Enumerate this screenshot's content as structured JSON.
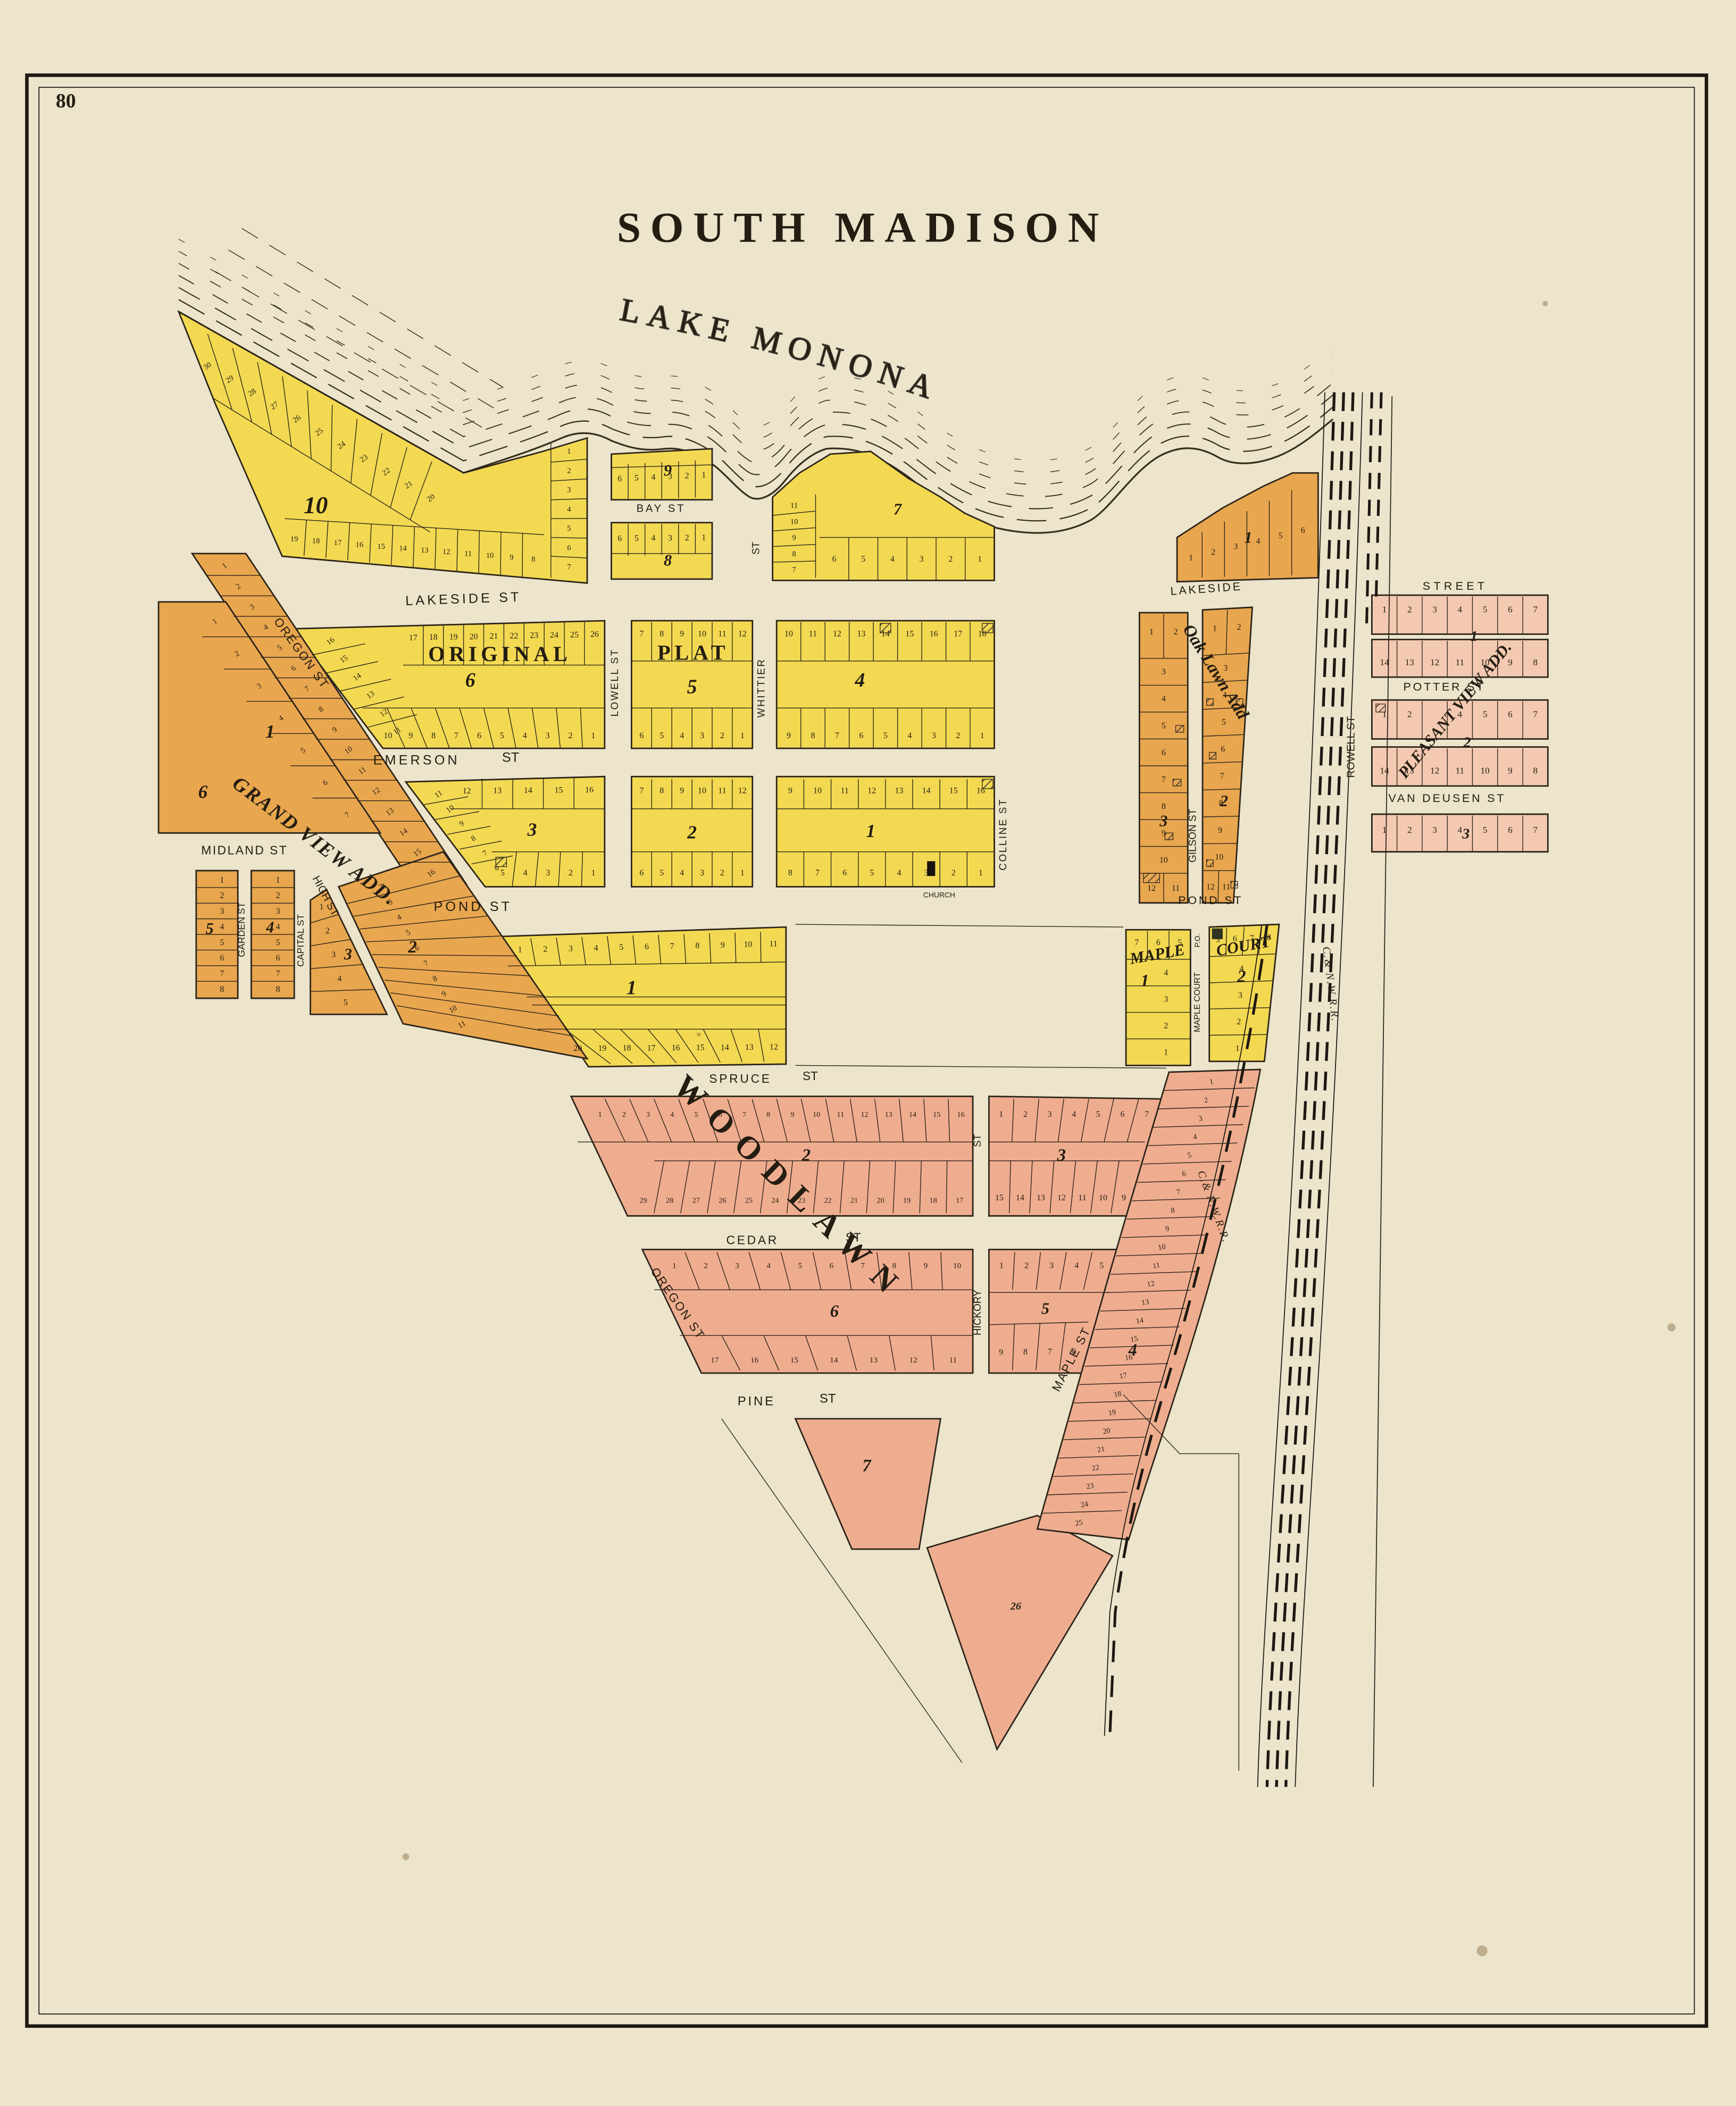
{
  "page": {
    "number": "80",
    "title": "SOUTH MADISON"
  },
  "lake": {
    "name": "LAKE MONONA"
  },
  "railroads": {
    "west_label": "C.& N.W.R.R.",
    "east_label": "C.& N.W.R.R."
  },
  "streets": {
    "lakeside_w": "LAKESIDE ST",
    "lakeside_e": "LAKESIDE",
    "bay": "BAY ST",
    "emerson": "EMERSON",
    "emerson_st": "ST",
    "lowell": "LOWELL ST",
    "whittier": "WHITTIER",
    "whittier_st": "ST",
    "colline": "COLLINE ST",
    "pond_w": "POND ST",
    "pond_e": "POND ST",
    "oregon_upper": "OREGON ST",
    "oregon_lower": "OREGON ST",
    "midland": "MIDLAND ST",
    "garden": "GARDEN ST",
    "capital": "CAPITAL ST",
    "high": "HIGH ST",
    "gilson": "GILSON ST",
    "rowell": "ROWELL ST",
    "street": "STREET",
    "potter": "POTTER ST",
    "van_deusen": "VAN DEUSEN ST",
    "spruce": "SPRUCE",
    "spruce_st": "ST",
    "cedar": "CEDAR",
    "cedar_st": "ST",
    "pine": "PINE",
    "pine_st": "ST",
    "hickory": "HICKORY",
    "hickory_st_upper": "ST",
    "maple": "MAPLE ST",
    "maple_court": "MAPLE COURT",
    "po": "P.O.",
    "church": "CHURCH"
  },
  "additions": {
    "original": "ORIGINAL",
    "plat": "PLAT",
    "grand_view": "GRAND VIEW ADD.",
    "oak_lawn": "Oak Lawn Add",
    "pleasant_view": "PLEASANT VIEW ADD.",
    "woodlawn": "WOODLAWN",
    "maple_court_1": "MAPLE",
    "maple_court_2": "COURT"
  },
  "blocks": {
    "op10": {
      "num": "10",
      "shore": [
        30,
        29,
        28,
        27,
        26,
        25,
        24,
        23,
        22,
        21,
        20
      ],
      "bottom": [
        19,
        18,
        17,
        16,
        15,
        14,
        13,
        12,
        11,
        10,
        9,
        8
      ],
      "east": [
        1,
        2,
        3,
        4,
        5,
        6,
        7
      ]
    },
    "op9": {
      "num": "9",
      "row": [
        6,
        5,
        4,
        3,
        2,
        1
      ]
    },
    "op8": {
      "num": "8",
      "row": [
        6,
        5,
        4,
        3,
        2,
        1
      ]
    },
    "op7": {
      "num": "7",
      "west": [
        11,
        10,
        9,
        8,
        7
      ],
      "bottom": [
        6,
        5,
        4,
        3,
        2,
        1
      ]
    },
    "op6": {
      "num": "6",
      "top": [
        17,
        18,
        19,
        20,
        21,
        22,
        23,
        24,
        25,
        26
      ],
      "diag": [
        16,
        15,
        14,
        13,
        12,
        11
      ],
      "bottom": [
        10,
        9,
        8,
        7,
        6,
        5,
        4,
        3,
        2,
        1
      ]
    },
    "op5": {
      "num": "5",
      "top": [
        7,
        8,
        9,
        10,
        11,
        12
      ],
      "bottom": [
        6,
        5,
        4,
        3,
        2,
        1
      ]
    },
    "op4": {
      "num": "4",
      "top": [
        10,
        11,
        12,
        13,
        14,
        15,
        16,
        17,
        18
      ],
      "bottom": [
        9,
        8,
        7,
        6,
        5,
        4,
        3,
        2,
        1
      ]
    },
    "op3": {
      "num": "3",
      "top": [
        12,
        13,
        14,
        15,
        16
      ],
      "diag": [
        11,
        10,
        9,
        8,
        7,
        6
      ],
      "bottom": [
        5,
        4,
        3,
        2,
        1
      ]
    },
    "op2": {
      "num": "2",
      "top": [
        7,
        8,
        9,
        10,
        11,
        12
      ],
      "bottom": [
        6,
        5,
        4,
        3,
        2,
        1
      ]
    },
    "op1": {
      "num": "1",
      "top": [
        9,
        10,
        11,
        12,
        13,
        14,
        15,
        16
      ],
      "bottom": [
        8,
        7,
        6,
        5,
        4,
        3,
        2,
        1
      ]
    },
    "pond1": {
      "num": "1",
      "top": [
        1,
        2,
        3,
        4,
        5,
        6,
        7,
        8,
        9,
        10,
        11
      ],
      "bottom": [
        20,
        19,
        18,
        17,
        16,
        15,
        14,
        13,
        12
      ]
    },
    "mc1": {
      "num": "1",
      "top": [
        7,
        6,
        5
      ],
      "rows": [
        4,
        3,
        2,
        1
      ]
    },
    "mc2": {
      "num": "2",
      "top": [
        5,
        6,
        7,
        8
      ],
      "rows": [
        4,
        3,
        2,
        1
      ]
    },
    "gv1": {
      "num": "1",
      "lots": [
        1,
        2,
        3,
        4,
        5,
        6,
        7,
        8,
        9,
        10,
        11,
        12,
        13,
        14,
        15,
        16
      ]
    },
    "gv2": {
      "num": "2",
      "lots": [
        2,
        3,
        4,
        5,
        6,
        7,
        8,
        9,
        10,
        11
      ]
    },
    "gv3": {
      "num": "3",
      "rows": [
        1,
        2,
        3,
        4,
        5
      ]
    },
    "gv4": {
      "num": "4",
      "rows": [
        1,
        2,
        3,
        4,
        5,
        6,
        7,
        8
      ]
    },
    "gv5": {
      "num": "5",
      "rows": [
        1,
        2,
        3,
        4,
        5,
        6,
        7,
        8
      ]
    },
    "gv6": {
      "num": "6",
      "lots": [
        1,
        2,
        3,
        4,
        5,
        6,
        7
      ]
    },
    "ol1": {
      "num": "1",
      "lots": [
        1,
        2,
        3,
        4,
        5,
        6
      ]
    },
    "ol2": {
      "num": "2",
      "pair": [
        1,
        2
      ],
      "rows": [
        3,
        4,
        5,
        6,
        7,
        8,
        9,
        10
      ],
      "last": [
        12,
        11
      ]
    },
    "ol3": {
      "num": "3",
      "pair": [
        1,
        2
      ],
      "rows": [
        3,
        4,
        5,
        6,
        7,
        8,
        9,
        10
      ],
      "last": [
        12,
        11
      ]
    },
    "pv1": {
      "num": "1",
      "top": [
        1,
        2,
        3,
        4,
        5,
        6,
        7
      ],
      "bottom": [
        14,
        13,
        12,
        11,
        10,
        9,
        8
      ]
    },
    "pv2": {
      "num": "2",
      "top": [
        "1",
        "2",
        "",
        "4",
        "5",
        "6",
        "7"
      ],
      "bottom": [
        14,
        13,
        12,
        11,
        10,
        9,
        8
      ]
    },
    "pv3": {
      "num": "3",
      "row": [
        1,
        2,
        3,
        4,
        5,
        6,
        7
      ]
    },
    "wd2": {
      "num": "2",
      "top": [
        1,
        2,
        3,
        4,
        5,
        6,
        7,
        8,
        9,
        10,
        11,
        12,
        13,
        14,
        15,
        16
      ],
      "bottom": [
        29,
        28,
        27,
        26,
        25,
        24,
        23,
        22,
        21,
        20,
        19,
        18,
        17
      ]
    },
    "wd3": {
      "num": "3",
      "top": [
        1,
        2,
        3,
        4,
        5,
        6,
        7
      ],
      "bottom": [
        15,
        14,
        13,
        12,
        11,
        10,
        9
      ]
    },
    "wd6": {
      "num": "6",
      "top": [
        1,
        2,
        3,
        4,
        5,
        6,
        7,
        8,
        9,
        10
      ],
      "bottom": [
        17,
        16,
        15,
        14,
        13,
        12,
        11
      ]
    },
    "wd5": {
      "num": "5",
      "top": [
        1,
        2,
        3,
        4,
        5
      ],
      "bottom": [
        9,
        8,
        7,
        6
      ]
    },
    "wd7": {
      "num": "7"
    },
    "wd4": {
      "num": "4",
      "lots": [
        1,
        2,
        3,
        4,
        5,
        6,
        7,
        8,
        9,
        10,
        11,
        12,
        13,
        14,
        15,
        16,
        17,
        18,
        19,
        20,
        21,
        22,
        23,
        24,
        25
      ]
    },
    "wd26": {
      "num": "26"
    }
  },
  "colors": {
    "paper": "#ece4cb",
    "yellow": "#f3d952",
    "orange": "#e8a64e",
    "salmon": "#efad8f",
    "pink": "#f3c9b1",
    "ink": "#241d12"
  }
}
